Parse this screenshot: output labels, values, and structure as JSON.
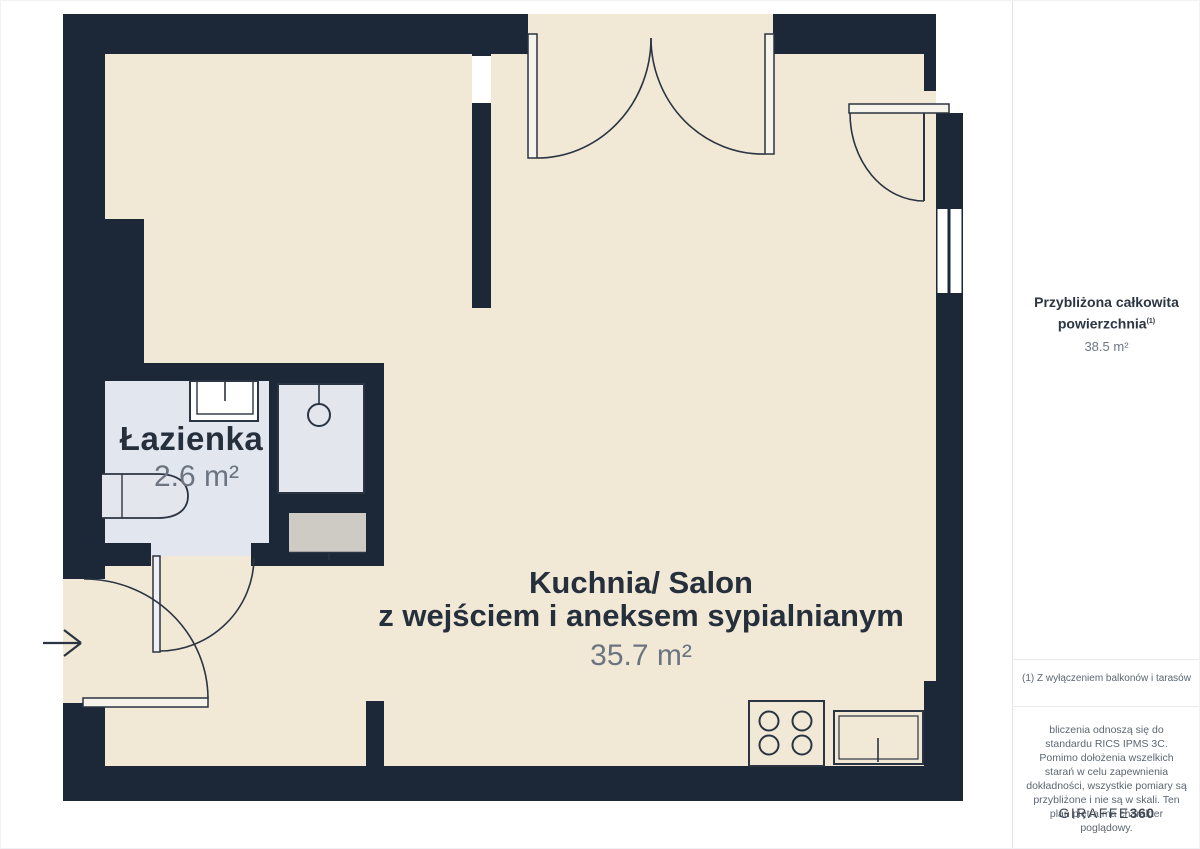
{
  "plan": {
    "rooms": [
      {
        "name": "Łazienka",
        "area": "2.6 m²"
      },
      {
        "name_line1": "Kuchnia/ Salon",
        "name_line2": "z wejściem i aneksem sypialnianym",
        "area": "35.7 m²"
      }
    ],
    "fixtures": [
      "bathroom-sink",
      "shower",
      "bathtub",
      "washing-machine",
      "stove",
      "kitchen-sink"
    ],
    "doors": [
      "entry-door",
      "bathroom-door",
      "double-door-top",
      "balcony-door"
    ],
    "windows": [
      "interior-window",
      "right-wall-window"
    ]
  },
  "sidebar": {
    "total_area_label": "Przybliżona całkowita powierzchnia",
    "total_area_sup": "(1)",
    "total_area_value": "38.5 m²",
    "footnote": "(1) Z wyłączeniem balkonów i tarasów",
    "disclaimer": "bliczenia odnoszą się do standardu RICS IPMS 3C. Pomimo dołożenia wszelkich starań w celu zapewnienia dokładności, wszystkie pomiary są przybliżone i nie są w skali. Ten plan piętra ma charakter poglądowy.",
    "logo_text": "GIRAFFE",
    "logo_suffix": "360"
  },
  "colors": {
    "wall": "#1c2737",
    "floor": "#f1e9d6",
    "bathroom_floor": "#e2e6ee",
    "appliance_gray": "#cecbc5",
    "outline": "#2b3442",
    "room_text": "#262f3c",
    "muted_text": "#6b7480"
  }
}
